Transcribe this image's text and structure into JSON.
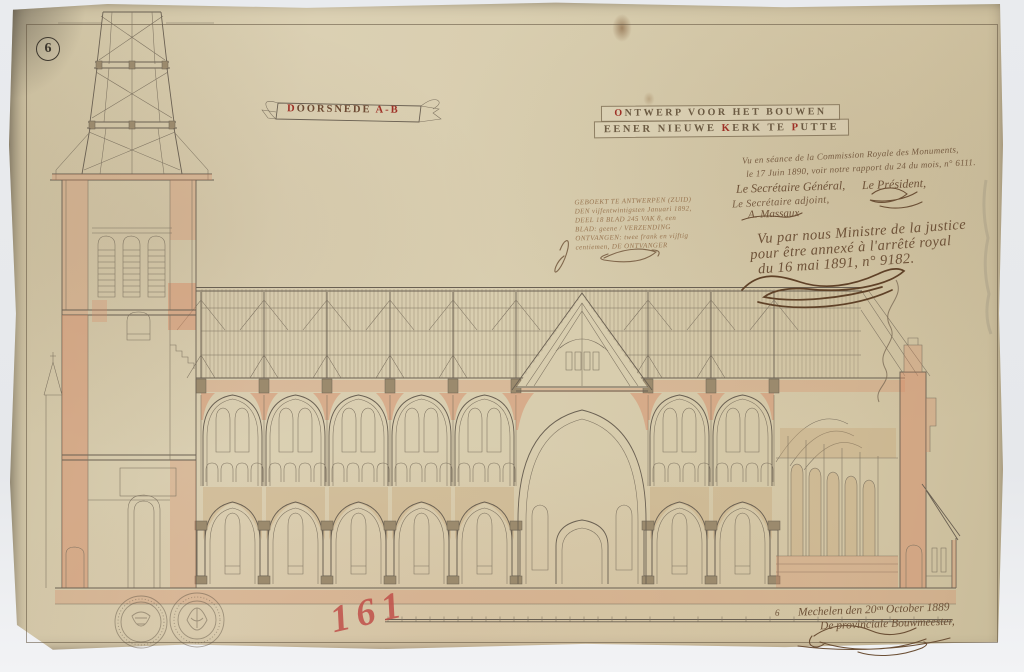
{
  "sheet": {
    "number": "6"
  },
  "banner": {
    "initial": "D",
    "rest": "OORSNEDE ",
    "red": "A-B"
  },
  "title": {
    "l1_initial": "O",
    "l1_rest": "NTWERP VOOR HET BOUWEN",
    "l2_a": "EENER NIEUWE ",
    "l2_k": "K",
    "l2_b": "ERK TE ",
    "l2_p": "P",
    "l2_c": "UTTE"
  },
  "commission": {
    "line1": "Vu en séance de la Commission Royale des Monuments,",
    "line2": "le 17 Juin 1890, voir notre rapport du 24 du mois, n° 6111.",
    "secretary_role": "Le Secrétaire Général,",
    "secretary_adjoint": "Le Secrétaire adjoint,",
    "secretary_name": "A. Massaux",
    "president_role": "Le Président,"
  },
  "minister": {
    "line1": "Vu par nous Ministre de la justice",
    "line2": "pour être annexé à l'arrêté royal",
    "line3": "du 16 mai 1891, n° 9182."
  },
  "registration_stamp": {
    "line1": "GEBOEKT TE ANTWERPEN (ZUID)",
    "line2": "DEN vijfentwintigsten Januari 1892,",
    "line3": "DEEL 18  BLAD 245  VAK 8, een",
    "line4": "BLAD: geene / VERZENDING",
    "line5": "ONTVANGEN: twee frank en vijftig",
    "line6": "centiemen,        DE ONTVANGER"
  },
  "colophon": {
    "prefix": "6",
    "place_date": "Mechelen den 20ᵉⁿ October 1889",
    "role": "De provinciale Bouwmeester,"
  },
  "archive_number": "161",
  "colors": {
    "paper": "#d8cdae",
    "ink": "#6a6052",
    "wash_pink": "#d68c68",
    "wash_tan": "#c4a678",
    "title_red": "#9e3026",
    "pencil_red": "#c0504a"
  }
}
